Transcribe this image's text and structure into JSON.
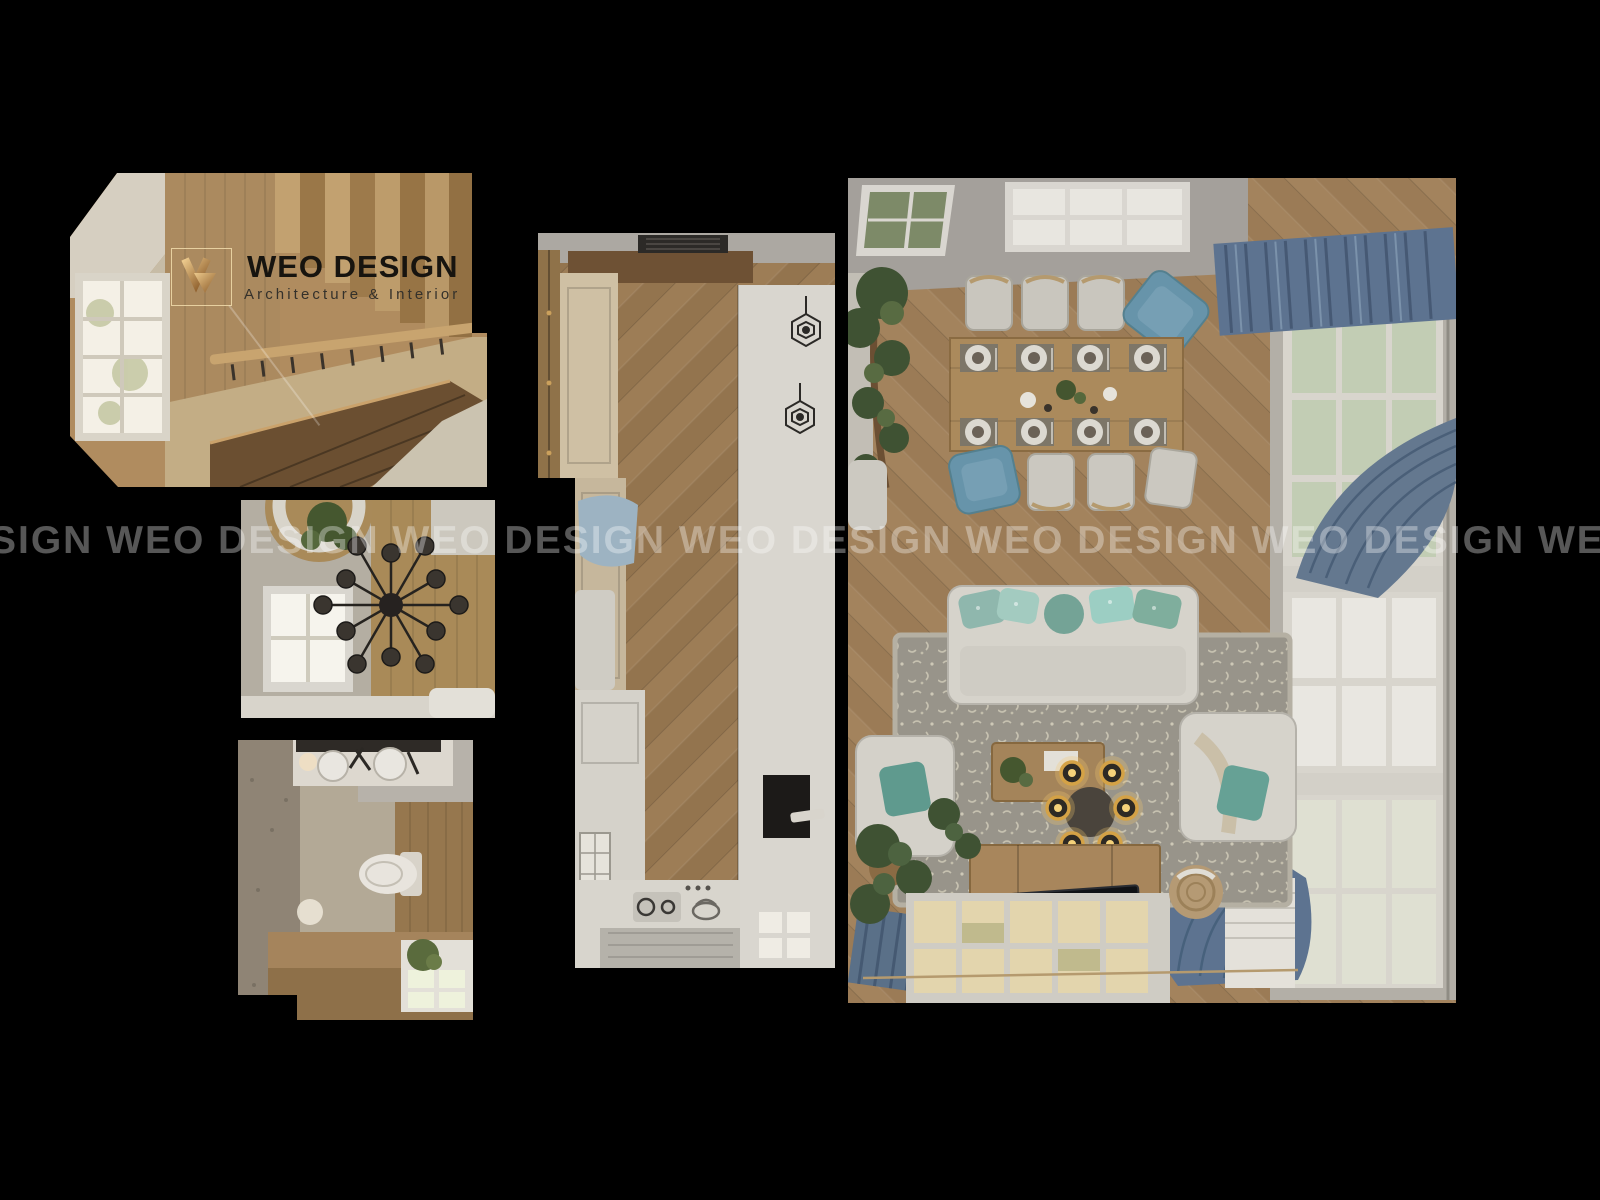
{
  "canvas": {
    "width": 1600,
    "height": 1200,
    "background": "#000000"
  },
  "brand": {
    "name": "WEO DESIGN",
    "tagline": "Architecture & Interior",
    "mark_accent": "#e0c089",
    "title_color": "#17140f",
    "tagline_color": "#34312b"
  },
  "watermark": {
    "text": "SIGN WEO DESIGN WEO DESIGN WEO DESIGN WEO DESIGN WEO DESIGN WEO DE",
    "color": "rgba(255,255,255,0.34)"
  },
  "palette": {
    "wood_floor": "#97774f",
    "wood_light": "#b59267",
    "ceiling_gray": "#a9a59f",
    "white_furniture": "#d6d3cb",
    "curtain_blue": "#5d7390",
    "armchair_blue": "#6794aa",
    "pillow_teal": "#74a396",
    "rug_gray": "#98948a",
    "gold_lamp": "#d4a246",
    "plant_green": "#4a5c36"
  },
  "panels": [
    {
      "id": "staircase",
      "label": "stairwell top view"
    },
    {
      "id": "bedroom",
      "label": "bedroom chandelier top view"
    },
    {
      "id": "bathroom",
      "label": "bathroom top view"
    },
    {
      "id": "kitchen-hall",
      "label": "kitchen hallway top view"
    },
    {
      "id": "living-dining",
      "label": "living dining room top view"
    }
  ]
}
